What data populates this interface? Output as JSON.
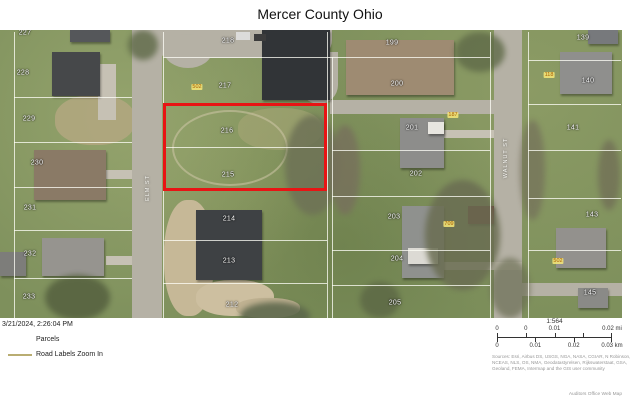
{
  "title": "Mercer County Ohio",
  "map": {
    "parcel_labels": [
      {
        "text": "227",
        "x": 25,
        "y": 3
      },
      {
        "text": "228",
        "x": 23,
        "y": 43
      },
      {
        "text": "229",
        "x": 29,
        "y": 89
      },
      {
        "text": "230",
        "x": 37,
        "y": 133
      },
      {
        "text": "231",
        "x": 30,
        "y": 178
      },
      {
        "text": "232",
        "x": 30,
        "y": 224
      },
      {
        "text": "233",
        "x": 29,
        "y": 267
      },
      {
        "text": "218",
        "x": 228,
        "y": 11
      },
      {
        "text": "217",
        "x": 225,
        "y": 56
      },
      {
        "text": "216",
        "x": 227,
        "y": 101
      },
      {
        "text": "215",
        "x": 228,
        "y": 145
      },
      {
        "text": "214",
        "x": 229,
        "y": 189
      },
      {
        "text": "213",
        "x": 229,
        "y": 231
      },
      {
        "text": "212",
        "x": 232,
        "y": 275
      },
      {
        "text": "199",
        "x": 392,
        "y": 13
      },
      {
        "text": "200",
        "x": 397,
        "y": 54
      },
      {
        "text": "201",
        "x": 412,
        "y": 98
      },
      {
        "text": "202",
        "x": 416,
        "y": 144
      },
      {
        "text": "203",
        "x": 394,
        "y": 187
      },
      {
        "text": "204",
        "x": 397,
        "y": 229
      },
      {
        "text": "205",
        "x": 395,
        "y": 273
      },
      {
        "text": "139",
        "x": 583,
        "y": 8
      },
      {
        "text": "140",
        "x": 588,
        "y": 51
      },
      {
        "text": "141",
        "x": 573,
        "y": 98
      },
      {
        "text": "143",
        "x": 592,
        "y": 185
      },
      {
        "text": "145",
        "x": 590,
        "y": 263
      }
    ],
    "address_labels": [
      {
        "text": "502",
        "x": 197,
        "y": 57
      },
      {
        "text": "187",
        "x": 453,
        "y": 85
      },
      {
        "text": "709",
        "x": 449,
        "y": 194
      },
      {
        "text": "118",
        "x": 549,
        "y": 45
      },
      {
        "text": "502",
        "x": 558,
        "y": 231
      }
    ],
    "road_labels": [
      {
        "text": "ELM ST",
        "x": 148,
        "y": 158
      },
      {
        "text": "WALNUT ST",
        "x": 506,
        "y": 128
      }
    ]
  },
  "footer": {
    "timestamp": "3/21/2024, 2:26:04 PM",
    "legend": {
      "items": [
        {
          "symbol": "parcel-outline",
          "label": "Parcels"
        },
        {
          "symbol": "road-line",
          "label": "Road Labels Zoom In"
        }
      ]
    },
    "scale": {
      "ratio": "1:564",
      "mi_labels": [
        {
          "text": "0",
          "pos": 0
        },
        {
          "text": "0",
          "pos": 0.25
        },
        {
          "text": "0.01",
          "pos": 0.5
        },
        {
          "text": "0.02 mi",
          "pos": 1
        }
      ],
      "km_labels": [
        {
          "text": "0",
          "pos": 0
        },
        {
          "text": "0.01",
          "pos": 0.333
        },
        {
          "text": "0.02",
          "pos": 0.667
        },
        {
          "text": "0.03 km",
          "pos": 1
        }
      ]
    },
    "attribution": "Sources: Esri, Airbus DS, USGS, NGA, NASA, CGIAR, N Robinson, NCEAS, NLS, OS, NMA, Geodatastyrelsen, Rijkswaterstaat, GSA, Geoland, FEMA, Intermap and the GIS user community",
    "credit": "Auditors Office Web Map"
  }
}
